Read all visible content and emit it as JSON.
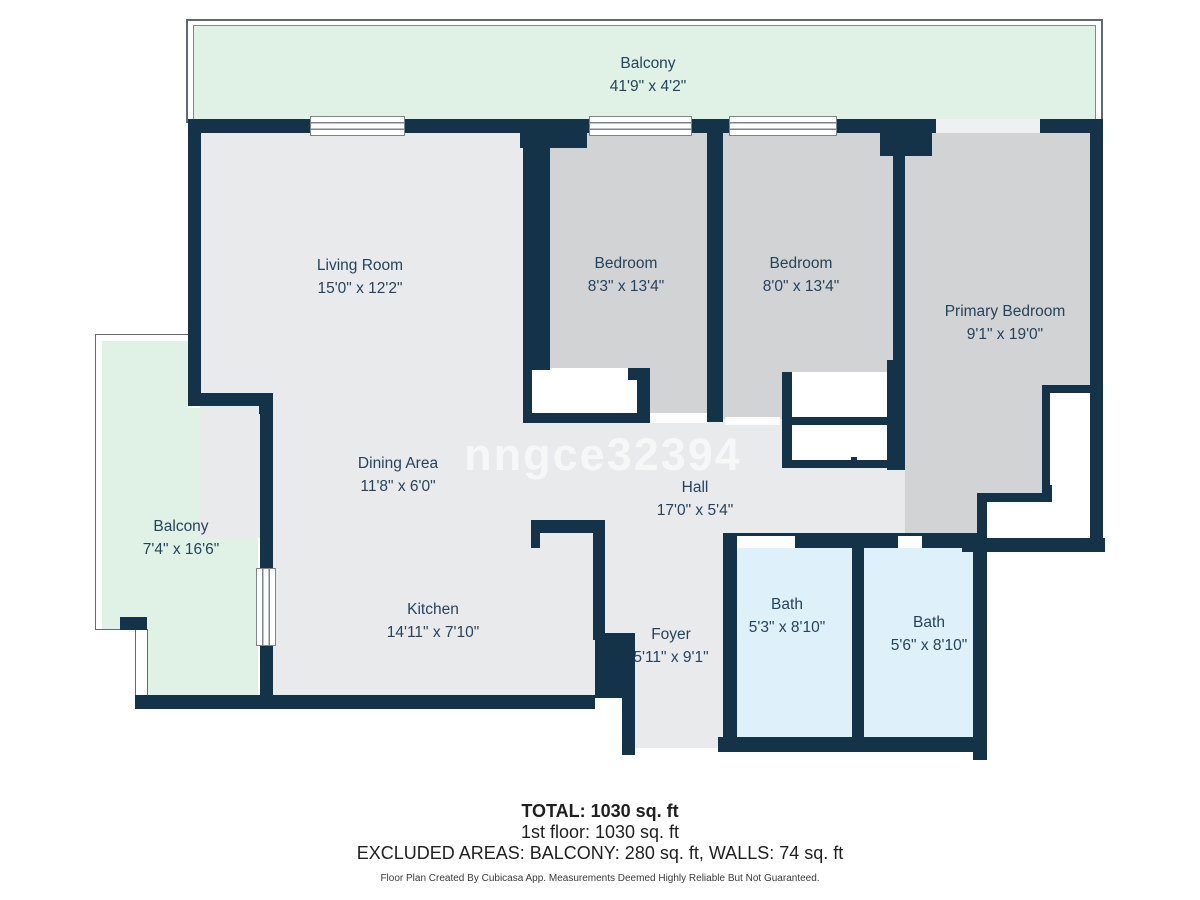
{
  "plan": {
    "watermark": "nngce32394",
    "rooms": {
      "balcony_top": {
        "name": "Balcony",
        "dims": "41'9\" x 4'2\""
      },
      "living": {
        "name": "Living Room",
        "dims": "15'0\" x 12'2\""
      },
      "bedroom1": {
        "name": "Bedroom",
        "dims": "8'3\" x 13'4\""
      },
      "bedroom2": {
        "name": "Bedroom",
        "dims": "8'0\" x 13'4\""
      },
      "primary": {
        "name": "Primary Bedroom",
        "dims": "9'1\" x 19'0\""
      },
      "dining": {
        "name": "Dining Area",
        "dims": "11'8\" x 6'0\""
      },
      "hall": {
        "name": "Hall",
        "dims": "17'0\" x 5'4\""
      },
      "balcony_left": {
        "name": "Balcony",
        "dims": "7'4\" x 16'6\""
      },
      "kitchen": {
        "name": "Kitchen",
        "dims": "14'11\" x 7'10\""
      },
      "foyer": {
        "name": "Foyer",
        "dims": "5'11\" x 9'1\""
      },
      "bath1": {
        "name": "Bath",
        "dims": "5'3\" x 8'10\""
      },
      "bath2": {
        "name": "Bath",
        "dims": "5'6\" x 8'10\""
      }
    }
  },
  "summary": {
    "total": "TOTAL: 1030 sq. ft",
    "floor1": "1st floor: 1030 sq. ft",
    "excluded": "EXCLUDED AREAS: BALCONY: 280 sq. ft, WALLS: 74 sq. ft",
    "disclaimer": "Floor Plan Created By Cubicasa App. Measurements Deemed Highly Reliable But Not Guaranteed."
  },
  "colors": {
    "wall": "#143349",
    "floor": "#e9eaeb",
    "bedroom_floor": "#d2d3d5",
    "bath_floor": "#def0fa",
    "balcony_floor": "#e0f2e5",
    "label_text": "#24435c",
    "summary_text": "#1f1f1f",
    "watermark_color": "rgba(255,255,255,0.6)"
  }
}
